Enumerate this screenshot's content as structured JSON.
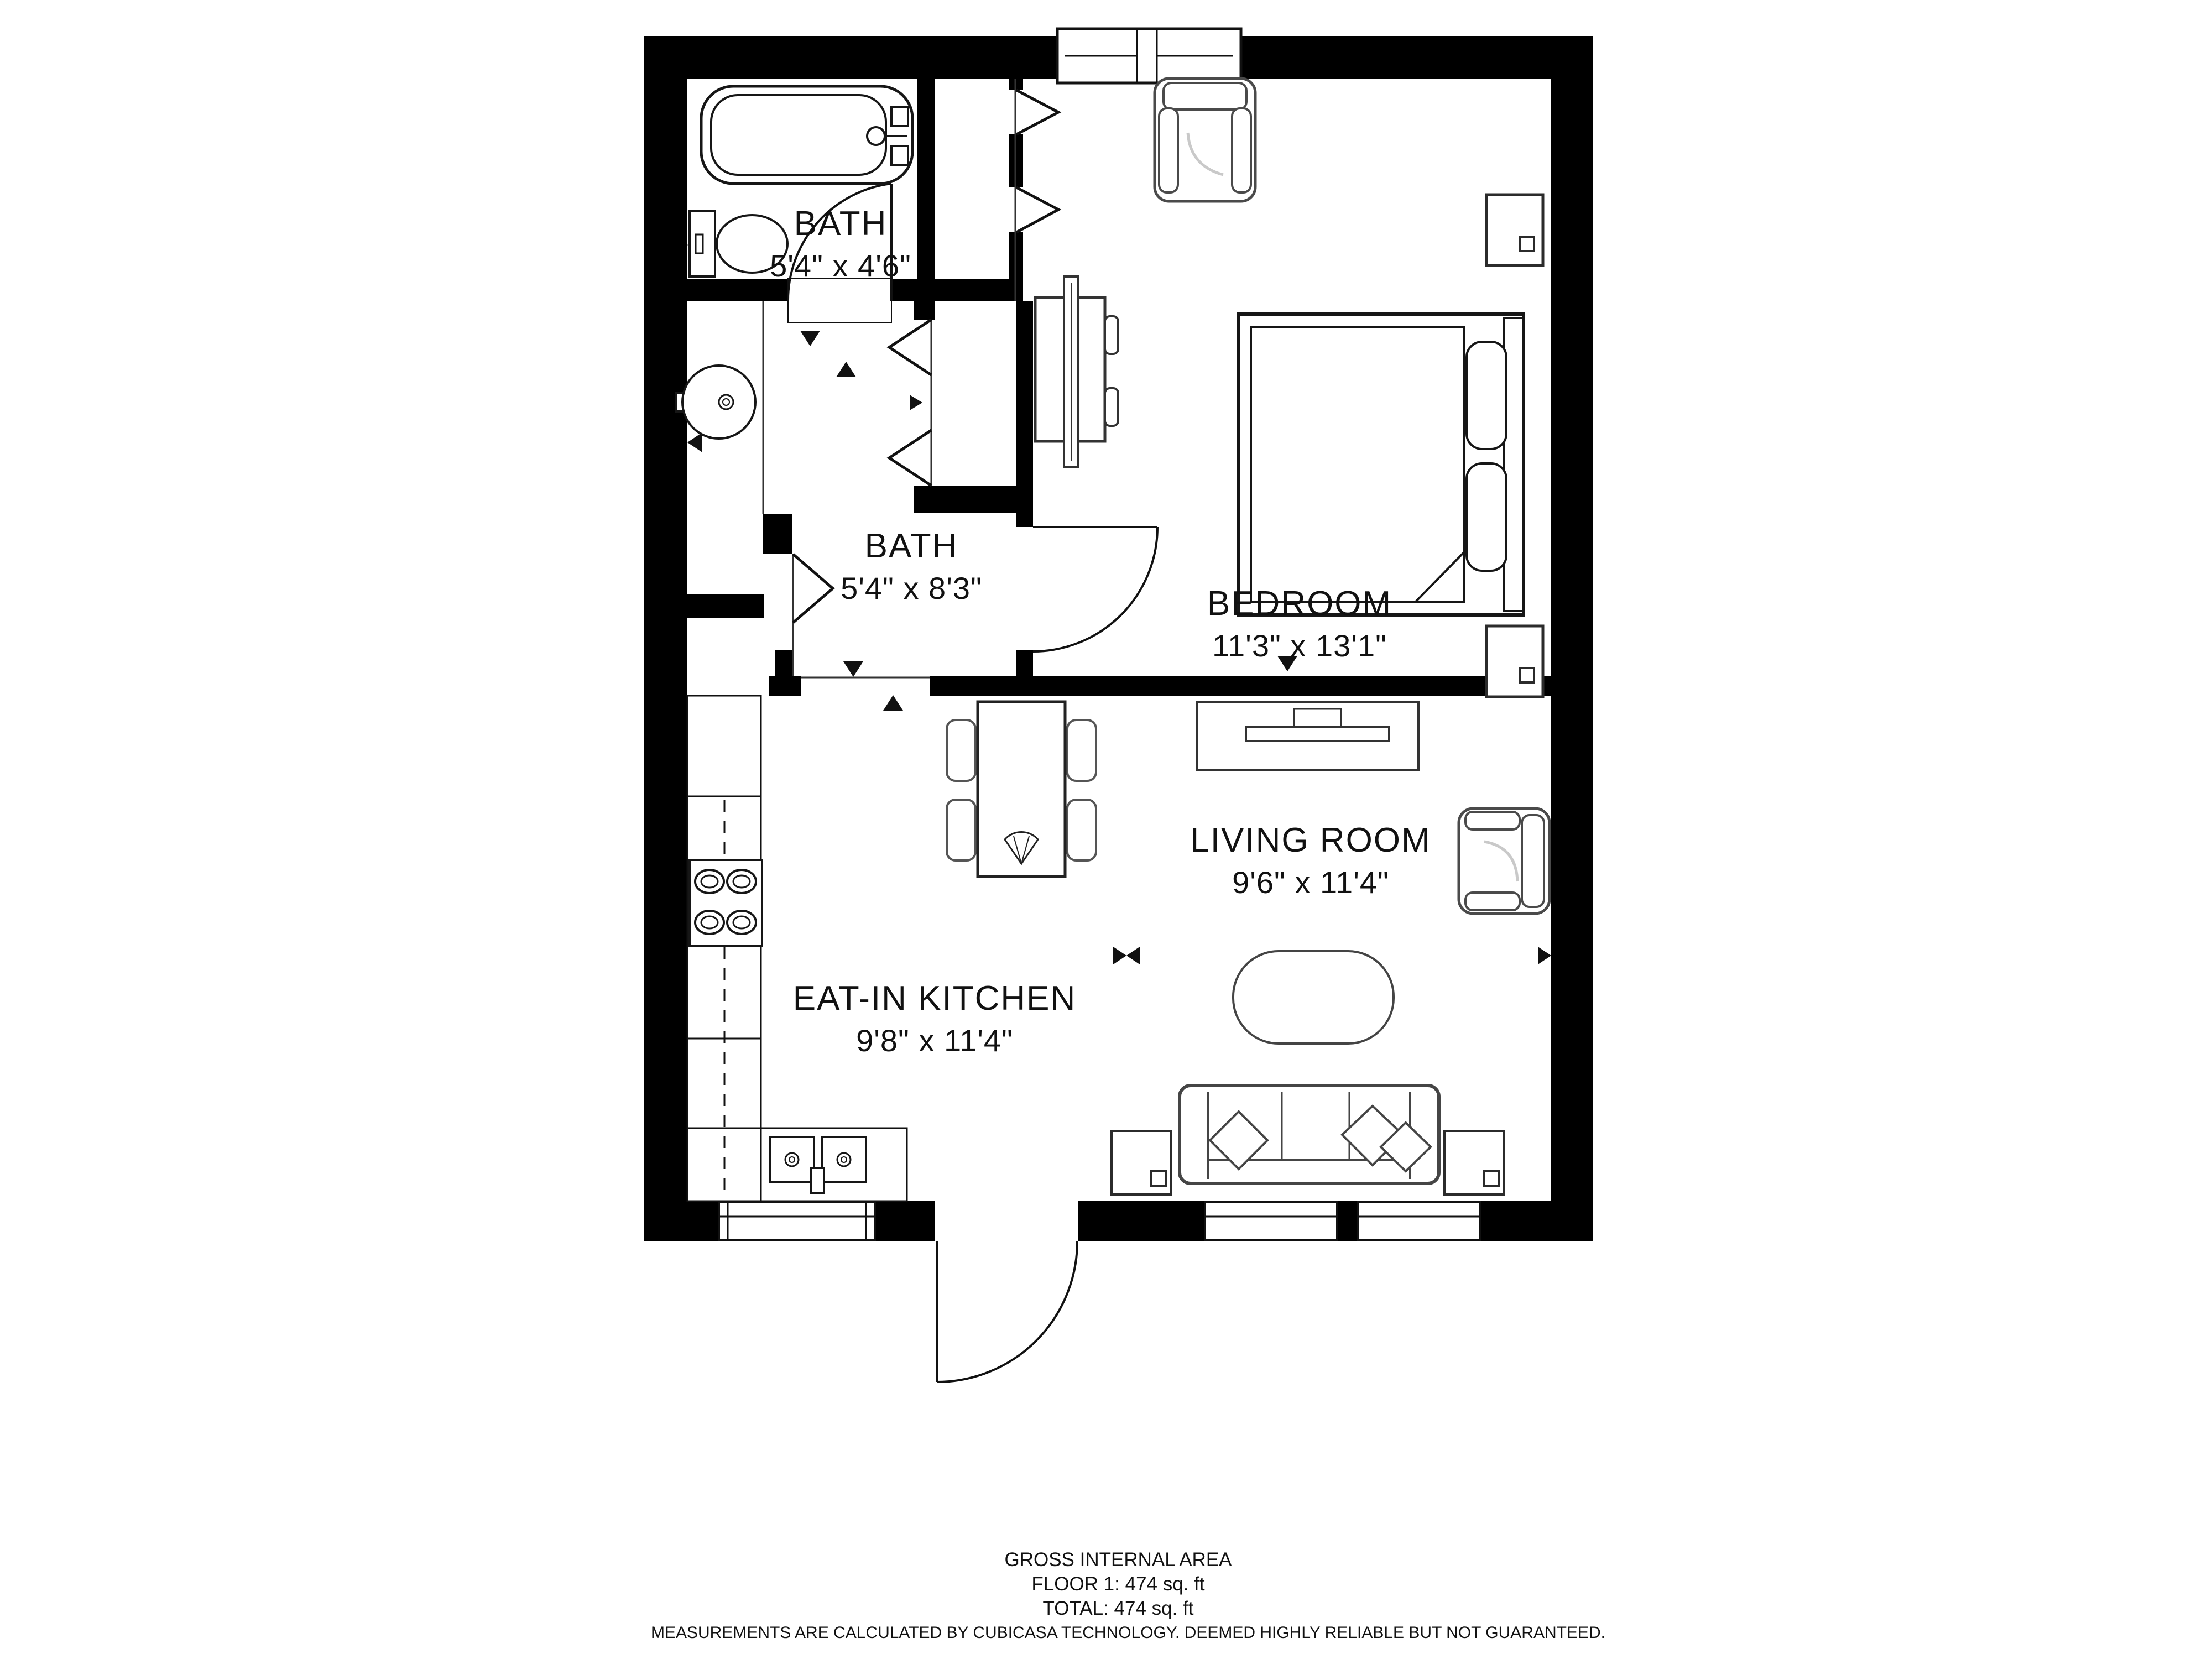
{
  "plan": {
    "title": "Floor plan — 1 bed 2 bath apartment",
    "rooms": [
      {
        "name": "BATH",
        "dims": "5'4\" x 4'6\""
      },
      {
        "name": "BATH",
        "dims": "5'4\" x 8'3\""
      },
      {
        "name": "BEDROOM",
        "dims": "11'3\" x 13'1\""
      },
      {
        "name": "LIVING ROOM",
        "dims": "9'6\" x 11'4\""
      },
      {
        "name": "EAT-IN KITCHEN",
        "dims": "9'8\" x 11'4\""
      }
    ],
    "icons": [
      "bathtub-icon",
      "toilet-icon",
      "pedestal-sink-icon",
      "stove-icon",
      "kitchen-sink-icon",
      "dining-table-icon",
      "chair-icon",
      "bed-icon",
      "nightstand-icon",
      "tv-icon",
      "tv-console-icon",
      "armchair-icon",
      "sofa-icon",
      "coffee-table-icon",
      "end-table-icon",
      "door-swing-icon",
      "bifold-door-icon",
      "window-icon",
      "direction-arrow-icon"
    ],
    "colors": {
      "wall": "#000000",
      "fixture": "#161616",
      "furniture": "#4a4a4a",
      "detail": "#c9c9c9",
      "background": "#ffffff"
    }
  },
  "footer": {
    "line1": "GROSS INTERNAL AREA",
    "line2": "FLOOR 1: 474 sq. ft",
    "line3": "TOTAL: 474 sq. ft",
    "disclaimer": "MEASUREMENTS ARE CALCULATED BY CUBICASA TECHNOLOGY. DEEMED HIGHLY RELIABLE BUT NOT GUARANTEED."
  }
}
